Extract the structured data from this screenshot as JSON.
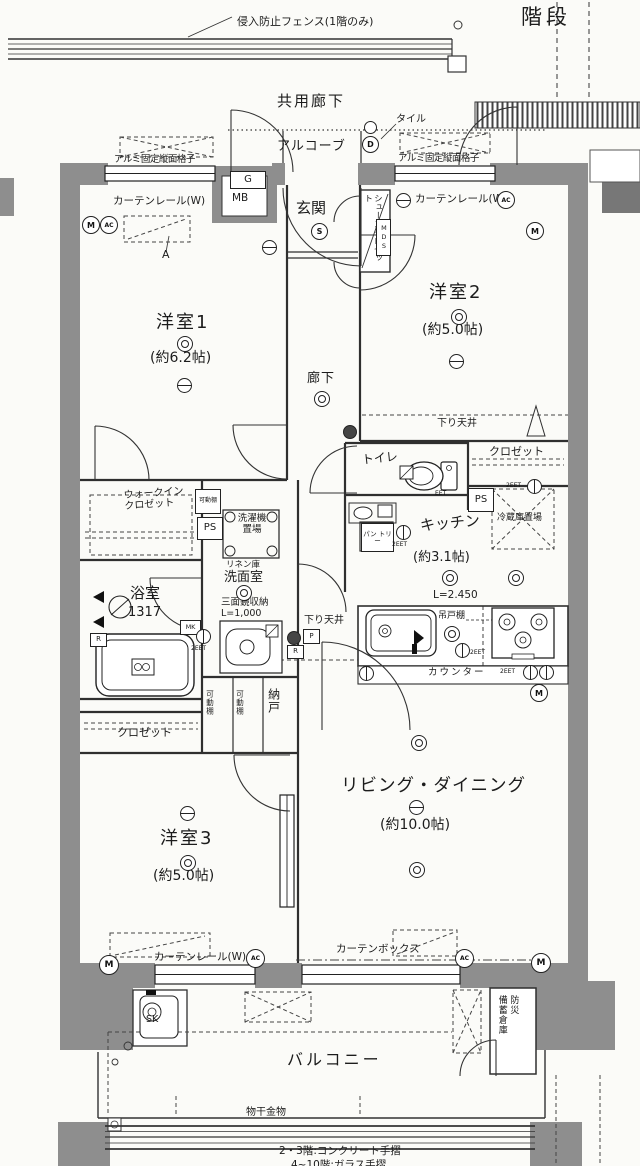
{
  "colors": {
    "wall": "#8e8e8e",
    "line": "#2f2f2f",
    "dark_block": "#777777"
  },
  "header": {
    "fence": "侵入防止フェンス(1階のみ)",
    "stairs": "階段",
    "common_corridor": "共用廊下",
    "tile": "タイル",
    "alcove": "アルコーブ"
  },
  "rooms": [
    {
      "name": "洋室1",
      "size": "(約6.2帖)"
    },
    {
      "name": "洋室2",
      "size": "(約5.0帖)"
    },
    {
      "name": "洋室3",
      "size": "(約5.0帖)"
    },
    {
      "name": "キッチン",
      "size": "(約3.1帖)"
    },
    {
      "name": "リビング・ダイニング",
      "size": "(約10.0帖)"
    },
    {
      "name": "玄関"
    },
    {
      "name": "廊下"
    },
    {
      "name": "トイレ"
    },
    {
      "name": "洗面室"
    },
    {
      "name": "浴室",
      "size": "1317"
    },
    {
      "name": "納戸"
    },
    {
      "name": "バルコニー"
    }
  ],
  "features": {
    "grille_left": "アルミ固定縦面格子",
    "grille_right": "アルミ固定縦面格子",
    "curtain_rail_tl": "カーテンレール(W)",
    "curtain_rail_tr": "カーテンレール(W)",
    "curtain_rail_bl": "カーテンレール(W)",
    "curtain_box": "カーテンボックス",
    "gas": "G",
    "meter_box": "MB",
    "shoe_closet": "シューズクロゼット",
    "mds": "MDS",
    "marker_a": "A",
    "lowered_ceiling_1": "下り天井",
    "lowered_ceiling_2": "下り天井",
    "closet_bedroom2": "クロゼット",
    "closet_bedroom3": "クロゼット",
    "walk_in_closet": "ウォークイン\nクロゼット",
    "movable_shelf_1": "可動棚",
    "movable_shelf_2": "可動棚",
    "movable_shelf_3": "可動棚",
    "ps_1": "PS",
    "ps_2": "PS",
    "washer_space": "洗濯機\n置場",
    "linen": "リネン庫",
    "mirror_cabinet": "三面鏡収納\nL=1,000",
    "mk": "MK",
    "pantry": "パン\nトリー",
    "fridge_space": "冷蔵庫置場",
    "counter_length": "L=2.450",
    "hanging_cupboard": "吊戸棚",
    "counter": "カウンター",
    "slop_sink": "SK",
    "disaster_storage": "防災\n備蓄倉庫",
    "laundry_hardware": "物干金物",
    "handrail_note_1": "2・3階:コンクリート手摺",
    "handrail_note_2": "4~10階:ガラス手摺"
  },
  "symbols": {
    "m": "M",
    "ac": "AC",
    "d": "D",
    "s": "S",
    "r": "R",
    "p": "P",
    "eet": "EET",
    "eet2": "2EET"
  }
}
